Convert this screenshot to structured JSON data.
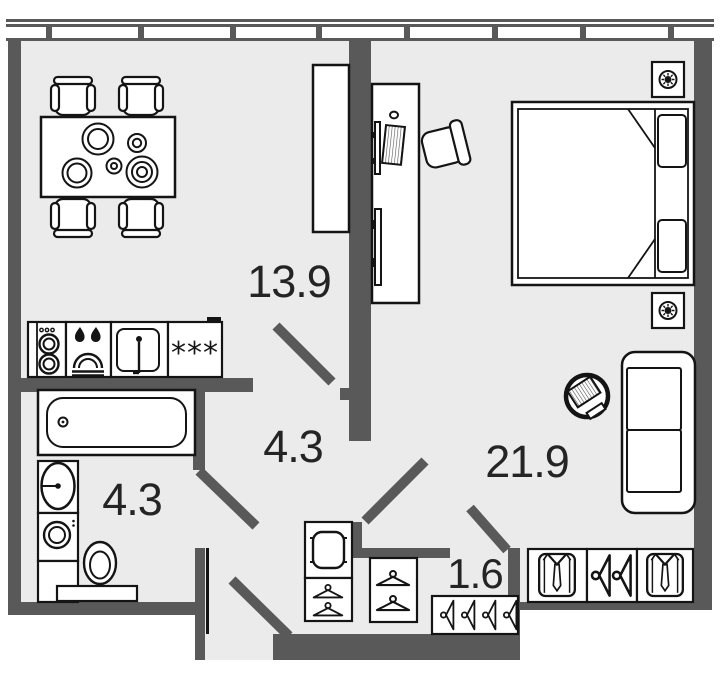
{
  "plan_title": "apartment-floor-plan",
  "colors": {
    "wall": "#595959",
    "floor": "#ebebeb",
    "outline": "#141414",
    "fixture_fill": "#ffffff",
    "label_text": "#242424"
  },
  "rooms": [
    {
      "id": "kitchen-dining",
      "area": "13.9"
    },
    {
      "id": "hallway",
      "area": "4.3"
    },
    {
      "id": "bathroom",
      "area": "4.3"
    },
    {
      "id": "living-bedroom",
      "area": "21.9"
    },
    {
      "id": "wardrobe-closet",
      "area": "1.6"
    }
  ],
  "markings": {
    "freezer_stars": "***"
  },
  "windows": {
    "segments": 8
  },
  "furniture": [
    "dining-table",
    "dining-chairs",
    "kitchen-tall-cabinet",
    "appliance-column",
    "cooktop",
    "kitchen-sink",
    "fridge-freezer",
    "bathtub",
    "wash-basin",
    "washing-machine",
    "bathroom-cabinet",
    "toilet",
    "pouf-cabinet",
    "hallway-wardrobes",
    "closet-hanger-rail",
    "double-bed",
    "nightstands",
    "work-desk",
    "desk-chair",
    "tv-panel",
    "sofa",
    "side-table",
    "wardrobe-sections"
  ]
}
